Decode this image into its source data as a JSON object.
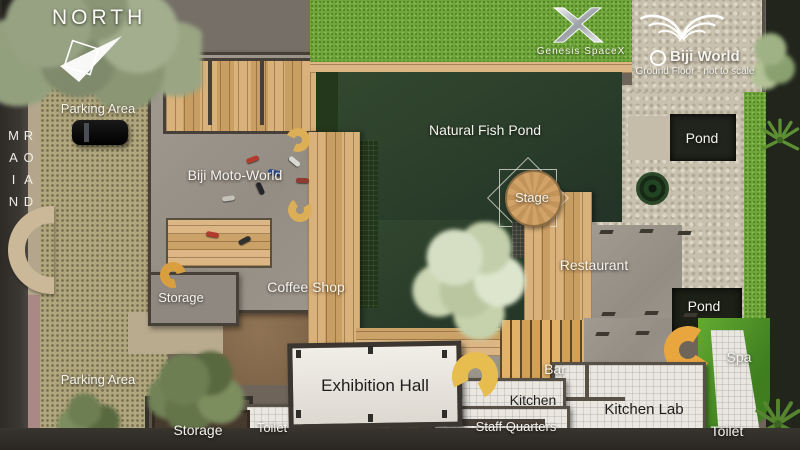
{
  "title": "Biji World Ground Floor Plan",
  "compass": {
    "label": "NORTH"
  },
  "road": {
    "label": "MAIN ROAD"
  },
  "branding": {
    "genesis": {
      "name": "Genesis SpaceX",
      "logo_icon": "x-logo"
    },
    "biji": {
      "name": "Biji World",
      "subtitle": "Ground Floor - not to scale",
      "logo_icon": "wings-icon"
    }
  },
  "labels": {
    "parking_top": "Parking Area",
    "parking_bottom": "Parking Area",
    "moto_world": "Biji Moto-World",
    "storage_mid": "Storage",
    "storage_bottom": "Storage",
    "coffee_shop": "Coffee Shop",
    "fish_pond": "Natural Fish Pond",
    "stage": "Stage",
    "restaurant": "Restaurant",
    "pond_top": "Pond",
    "pond_bottom": "Pond",
    "spa": "Spa",
    "exhibition_hall": "Exhibition Hall",
    "bar": "Bar",
    "kitchen": "Kitchen",
    "kitchen_lab": "Kitchen Lab",
    "staff_quarters": "Staff Quarters",
    "toilet_left": "Toilet",
    "toilet_right": "Toilet"
  },
  "colors": {
    "grass": "#72a93c",
    "pond_water": "#2c402b",
    "spa_green": "#55a02c",
    "wood": "#d3aa72",
    "concrete": "#9c958b",
    "parking": "#b1a77e",
    "pebble": "#c9c1af",
    "road": "#34302b",
    "white_roof": "#eae7e1",
    "stair_orange": "#e9a63f",
    "stair_yellow": "#e6bd4e"
  }
}
